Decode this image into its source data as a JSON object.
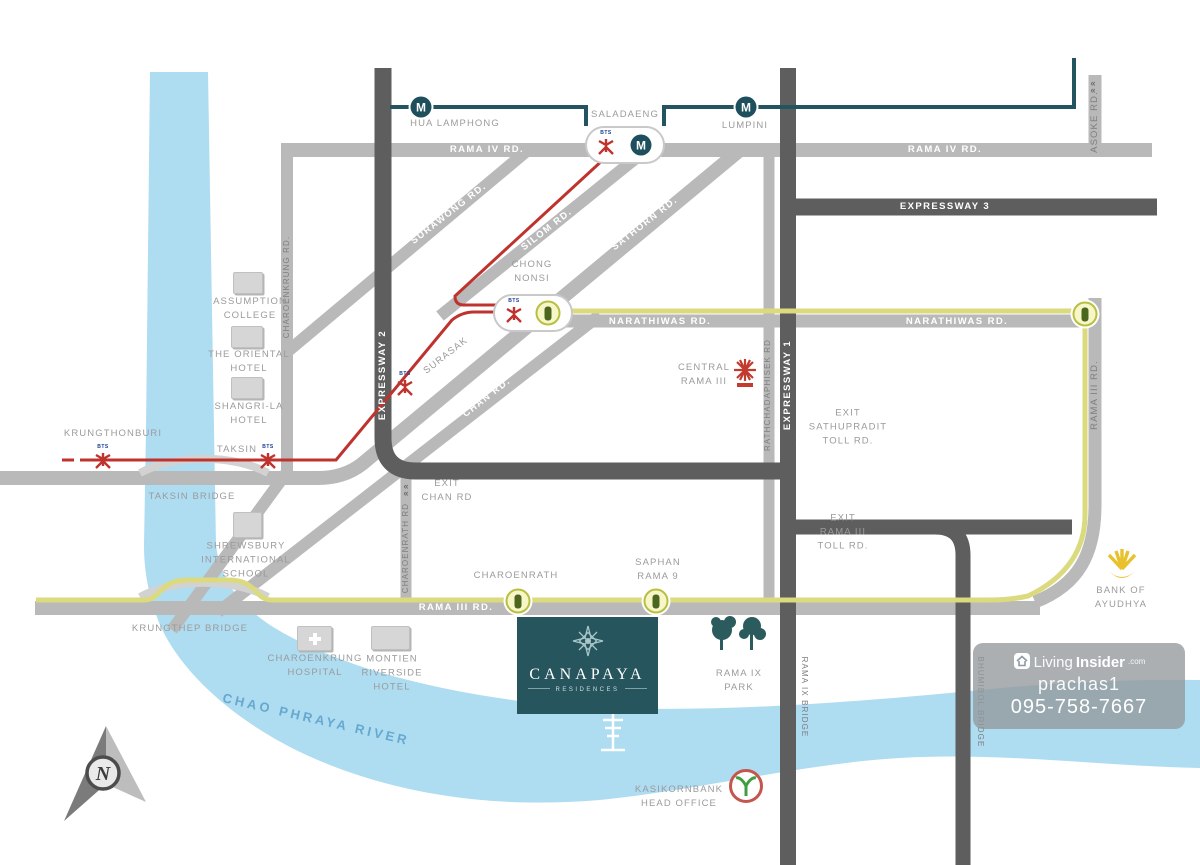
{
  "title": "Canapaya Residences location map",
  "project": {
    "name": "CANAPAYA",
    "subtitle": "RESIDENCES"
  },
  "river": {
    "label": "CHAO PHRAYA RIVER"
  },
  "compass": {
    "label": "N"
  },
  "icons": {
    "mrt_letter": "M",
    "bts_text": "BTS",
    "exit_chevron": "«\n«"
  },
  "stations": {
    "hua_lamphong": "HUA LAMPHONG",
    "saladaeng": "SALADAENG",
    "lumpini": "LUMPINI",
    "chong_nonsi": "CHONG\nNONSI",
    "surasak": "SURASAK",
    "taksin": "TAKSIN",
    "krungthonburi": "KRUNGTHONBURI",
    "charoenrath": "CHAROENRATH",
    "saphan_rama9": "SAPHAN\nRAMA 9"
  },
  "roads": {
    "rama4_w": "RAMA IV RD.",
    "rama4_e": "RAMA IV RD.",
    "expressway3": "EXPRESSWAY 3",
    "narathiwas_w": "NARATHIWAS RD.",
    "narathiwas_e": "NARATHIWAS RD.",
    "expressway2": "EXPRESSWAY 2",
    "expressway1": "EXPRESSWAY 1",
    "ratchadaphisek": "RATHCHADAPHISEK RD",
    "asoke": "ASOKE RD.",
    "charoenkrung": "CHAROENKRUNG RD.",
    "surawong": "SURAWONG RD.",
    "silom": "SILOM RD.",
    "sathorn": "SATHORN RD.",
    "chan": "CHAN RD.",
    "rama3_h": "RAMA III RD.",
    "rama3_v": "RAMA III RD.",
    "charoenrath_rd": "CHAROENRATH RD"
  },
  "bridges": {
    "taksin": "TAKSIN BRIDGE",
    "krungthep": "KRUNGTHEP BRIDGE",
    "rama9": "RAMA IX BRIDGE",
    "bhumibol": "BHUMIBOL BRIDGE"
  },
  "exits": {
    "chan": "EXIT\nCHAN RD",
    "sathupradit": "EXIT\nSATHUPRADIT\nTOLL RD.",
    "rama3": "EXIT\nRAMA III\nTOLL RD."
  },
  "landmarks": {
    "assumption": "ASSUMPTION\nCOLLEGE",
    "oriental": "THE ORIENTAL\nHOTEL",
    "shangrila": "SHANGRI-LA\nHOTEL",
    "shrewsbury": "SHREWSBURY\nINTERNATIONAL\nSCHOOL",
    "hospital": "CHAROENKRUNG\nHOSPITAL",
    "montien": "MONTIEN\nRIVERSIDE\nHOTEL",
    "central": "CENTRAL\nRAMA III",
    "park": "RAMA IX\nPARK",
    "kasikorn": "KASIKORNBANK\nHEAD OFFICE",
    "ayudhya": "BANK OF\nAYUDHYA"
  },
  "watermark": {
    "brand_light": "Living",
    "brand_bold": "Insider",
    "brand_suffix": ".com",
    "username": "prachas1",
    "phone": "095-758-7667"
  },
  "colors": {
    "road": "#b9b9b9",
    "expressway": "#5e5e5e",
    "mrt_line": "#24545f",
    "bts_line": "#bf332e",
    "brt_line": "#dbda7e",
    "river": "#aedcf1",
    "project_block": "#27555e"
  }
}
